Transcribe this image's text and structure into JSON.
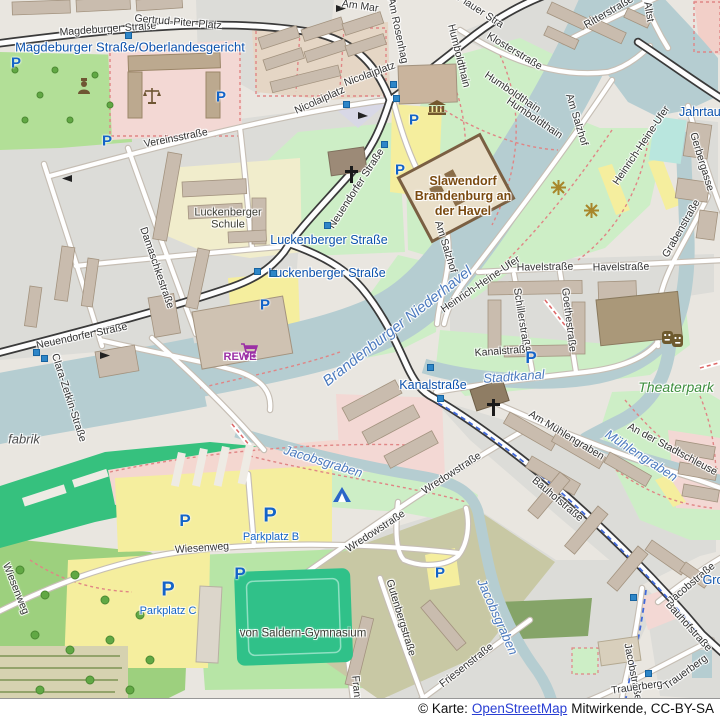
{
  "attribution": {
    "prefix": "© Karte:",
    "link": "OpenStreetMap",
    "suffix": "Mitwirkende, CC-BY-SA"
  },
  "map": {
    "parking_glyph": "P",
    "colors": {
      "water": "#b5cdd1",
      "park_green": "#cdeec6",
      "transit_blue": "#0c52ad",
      "water_label_blue": "#4d7bbf",
      "tourism_brown": "#7a4a10",
      "rewe_purple": "#9b2fa5",
      "park_label_green": "#3e8e3e",
      "parking_blue": "#1464c8",
      "main_road_casing": "#3a3a3a",
      "parking_area_yellow": "#f5ee9e",
      "retail_pink": "#f3d8d4"
    },
    "street_labels": [
      {
        "text": "Magdeburger Straße",
        "x": 108,
        "y": 30,
        "rot": -4
      },
      {
        "text": "Gertrud-Piter-Platz",
        "x": 178,
        "y": 23,
        "rot": 5
      },
      {
        "text": "Vereinsstraße",
        "x": 176,
        "y": 139,
        "rot": -11
      },
      {
        "text": "Nicolaiplatz",
        "x": 320,
        "y": 101,
        "rot": -24
      },
      {
        "text": "Nicolaiplatz",
        "x": 370,
        "y": 75,
        "rot": -20
      },
      {
        "text": "Am Mar",
        "x": 360,
        "y": 7,
        "rot": 8
      },
      {
        "text": "Am Rosenhag",
        "x": 397,
        "y": 31,
        "rot": 78
      },
      {
        "text": "Plauer Stra",
        "x": 480,
        "y": 12,
        "rot": 33
      },
      {
        "text": "Ritterstraße",
        "x": 609,
        "y": 13,
        "rot": -30
      },
      {
        "text": "Altst",
        "x": 648,
        "y": 12,
        "rot": 80
      },
      {
        "text": "Klosterstraße",
        "x": 514,
        "y": 52,
        "rot": 31
      },
      {
        "text": "Humboldthain",
        "x": 458,
        "y": 56,
        "rot": 76
      },
      {
        "text": "Humboldthain",
        "x": 512,
        "y": 93,
        "rot": 34
      },
      {
        "text": "Humboldthain",
        "x": 534,
        "y": 119,
        "rot": 34
      },
      {
        "text": "Neuendorfer Straße",
        "x": 357,
        "y": 189,
        "rot": -57
      },
      {
        "text": "Neuendorfer Straße",
        "x": 82,
        "y": 337,
        "rot": -12
      },
      {
        "text": "Damaschkestraße",
        "x": 156,
        "y": 268,
        "rot": 71
      },
      {
        "text": "Clara-Zetkin-Straße",
        "x": 68,
        "y": 398,
        "rot": 72
      },
      {
        "text": "Am Salzhof",
        "x": 576,
        "y": 120,
        "rot": 73
      },
      {
        "text": "Am Salzhof",
        "x": 445,
        "y": 247,
        "rot": 73
      },
      {
        "text": "Heinrich-Heine-Ufer",
        "x": 642,
        "y": 146,
        "rot": -56
      },
      {
        "text": "Heinrich-Heine-Ufer",
        "x": 481,
        "y": 285,
        "rot": -34
      },
      {
        "text": "Gerbergasse",
        "x": 701,
        "y": 162,
        "rot": 73
      },
      {
        "text": "Havelstraße",
        "x": 545,
        "y": 268,
        "rot": -1
      },
      {
        "text": "Havelstraße",
        "x": 621,
        "y": 268,
        "rot": -1
      },
      {
        "text": "Grabenstraße",
        "x": 682,
        "y": 229,
        "rot": -60
      },
      {
        "text": "Schillerstraße",
        "x": 521,
        "y": 320,
        "rot": 81
      },
      {
        "text": "Goethestraße",
        "x": 568,
        "y": 320,
        "rot": 83
      },
      {
        "text": "Kanalstraße",
        "x": 503,
        "y": 352,
        "rot": -4
      },
      {
        "text": "Am Mühlengraben",
        "x": 566,
        "y": 436,
        "rot": 31
      },
      {
        "text": "An der Stadtschleuse",
        "x": 672,
        "y": 450,
        "rot": 28
      },
      {
        "text": "Wredowstraße",
        "x": 376,
        "y": 532,
        "rot": -33
      },
      {
        "text": "Wredowstraße",
        "x": 452,
        "y": 474,
        "rot": -33
      },
      {
        "text": "Wiesenweg",
        "x": 202,
        "y": 549,
        "rot": -4
      },
      {
        "text": "Wiesenweg",
        "x": 15,
        "y": 589,
        "rot": 68
      },
      {
        "text": "Gutenbergstraße",
        "x": 400,
        "y": 618,
        "rot": 73
      },
      {
        "text": "Bauhofstraße",
        "x": 557,
        "y": 500,
        "rot": 40
      },
      {
        "text": "Bauhofstraße",
        "x": 688,
        "y": 627,
        "rot": 48
      },
      {
        "text": "Jacobstraße",
        "x": 692,
        "y": 584,
        "rot": -40
      },
      {
        "text": "Jacobstraße",
        "x": 632,
        "y": 672,
        "rot": 79
      },
      {
        "text": "Trauerberg",
        "x": 637,
        "y": 688,
        "rot": -8
      },
      {
        "text": "Trauerberg",
        "x": 686,
        "y": 673,
        "rot": -36
      },
      {
        "text": "Friesenstraße",
        "x": 467,
        "y": 666,
        "rot": -38
      },
      {
        "text": "Franz-Z",
        "x": 356,
        "y": 694,
        "rot": 85
      }
    ],
    "transit_labels": [
      {
        "text": "Magdeburger Straße/Oberlandesgericht",
        "x": 130,
        "y": 48,
        "size": 13
      },
      {
        "text": "Luckenberger Straße",
        "x": 329,
        "y": 240,
        "size": 12.5
      },
      {
        "text": "Luckenberger Straße",
        "x": 327,
        "y": 273,
        "size": 12.5
      },
      {
        "text": "Kanalstraße",
        "x": 433,
        "y": 385,
        "size": 12.5
      },
      {
        "text": "Jahrtaus",
        "x": 703,
        "y": 112,
        "size": 12.5
      },
      {
        "text": "Gro",
        "x": 713,
        "y": 580,
        "size": 12.5
      }
    ],
    "water_labels": [
      {
        "text": "Brandenburger Niederhavel",
        "x": 398,
        "y": 327,
        "rot": -38,
        "size": 15
      },
      {
        "text": "Stadtkanal",
        "x": 514,
        "y": 377,
        "rot": -4,
        "size": 13
      },
      {
        "text": "Mühlengraben",
        "x": 641,
        "y": 456,
        "rot": 33,
        "size": 13
      },
      {
        "text": "Jacobsgraben",
        "x": 323,
        "y": 462,
        "rot": 17,
        "size": 13
      },
      {
        "text": "Jacobsgraben",
        "x": 497,
        "y": 617,
        "rot": 66,
        "size": 13
      }
    ],
    "area_labels": [
      {
        "kind": "school-label",
        "text": "Luckenberger Schule",
        "x": 228,
        "y": 219,
        "w": 88,
        "size": 11
      },
      {
        "kind": "school-label",
        "text": "von Saldern-Gymnasium",
        "x": 303,
        "y": 634,
        "size": 11.5
      },
      {
        "kind": "tourism-label",
        "text": "Slawendorf Brandenburg an der Havel",
        "x": 463,
        "y": 196,
        "w": 100,
        "size": 12.5
      },
      {
        "kind": "park-label",
        "text": "Theaterpark",
        "x": 676,
        "y": 388,
        "size": 14
      },
      {
        "kind": "industrial-label",
        "text": "fabrik",
        "x": 24,
        "y": 440,
        "size": 13
      },
      {
        "kind": "supermarket-label",
        "text": "REWE",
        "x": 240,
        "y": 357,
        "size": 11
      },
      {
        "kind": "parking-name-label",
        "text": "Parkplatz B",
        "x": 271,
        "y": 537,
        "w": 60,
        "size": 11
      },
      {
        "kind": "parking-name-label",
        "text": "Parkplatz C",
        "x": 168,
        "y": 611,
        "w": 60,
        "size": 11
      }
    ],
    "parking_icons": [
      {
        "x": 16,
        "y": 63,
        "size": 15
      },
      {
        "x": 221,
        "y": 97,
        "size": 15
      },
      {
        "x": 107,
        "y": 141,
        "size": 15
      },
      {
        "x": 414,
        "y": 120,
        "size": 15
      },
      {
        "x": 400,
        "y": 170,
        "size": 15
      },
      {
        "x": 265,
        "y": 305,
        "size": 15
      },
      {
        "x": 531,
        "y": 358,
        "size": 17
      },
      {
        "x": 270,
        "y": 516,
        "size": 20
      },
      {
        "x": 185,
        "y": 521,
        "size": 17
      },
      {
        "x": 240,
        "y": 574,
        "size": 17
      },
      {
        "x": 440,
        "y": 573,
        "size": 15
      },
      {
        "x": 168,
        "y": 590,
        "size": 20
      }
    ],
    "stop_squares": [
      {
        "x": 128,
        "y": 35
      },
      {
        "x": 393,
        "y": 84
      },
      {
        "x": 396,
        "y": 98
      },
      {
        "x": 346,
        "y": 104
      },
      {
        "x": 384,
        "y": 144
      },
      {
        "x": 327,
        "y": 225
      },
      {
        "x": 257,
        "y": 271
      },
      {
        "x": 273,
        "y": 273
      },
      {
        "x": 36,
        "y": 352
      },
      {
        "x": 44,
        "y": 358
      },
      {
        "x": 430,
        "y": 367
      },
      {
        "x": 440,
        "y": 398
      },
      {
        "x": 633,
        "y": 597
      },
      {
        "x": 648,
        "y": 673
      }
    ],
    "icons": [
      {
        "name": "museum",
        "x": 428,
        "y": 100
      },
      {
        "name": "courthouse",
        "x": 143,
        "y": 87
      },
      {
        "name": "workshop",
        "x": 77,
        "y": 78
      },
      {
        "name": "church",
        "x": 345,
        "y": 166
      },
      {
        "name": "church",
        "x": 487,
        "y": 399
      },
      {
        "name": "theater",
        "x": 662,
        "y": 331
      },
      {
        "name": "supermarket-cart",
        "x": 240,
        "y": 343
      },
      {
        "name": "campsite",
        "x": 333,
        "y": 487
      },
      {
        "name": "artwork",
        "x": 551,
        "y": 180
      },
      {
        "name": "artwork",
        "x": 584,
        "y": 203
      }
    ]
  }
}
